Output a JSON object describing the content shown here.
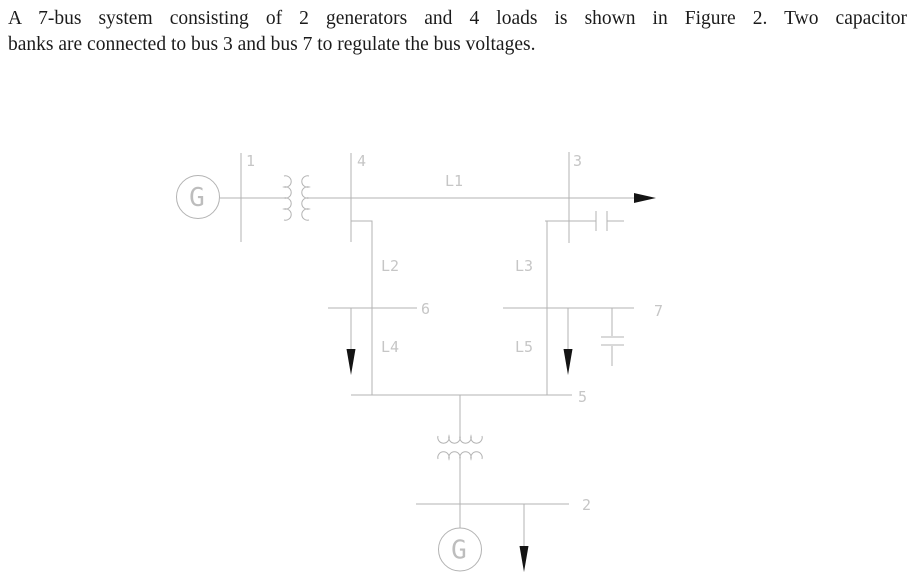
{
  "title": {
    "line1": "A 7-bus system consisting of 2 generators and 4 loads is shown in Figure 2. Two capacitor",
    "line2": "banks are connected to bus 3 and bus 7 to regulate the bus voltages."
  },
  "diagram": {
    "generator_symbol": "G",
    "bus_labels": {
      "bus1": "1",
      "bus2": "2",
      "bus3": "3",
      "bus4": "4",
      "bus5": "5",
      "bus6": "6",
      "bus7": "7"
    },
    "line_labels": {
      "l1": "L1",
      "l2": "L2",
      "l3": "L3",
      "l4": "L4",
      "l5": "L5"
    },
    "colors": {
      "line": "#b3b3b3",
      "label": "#c6c6c6",
      "arrow": "#141414",
      "text": "#1b1b1b",
      "background": "#ffffff"
    }
  }
}
